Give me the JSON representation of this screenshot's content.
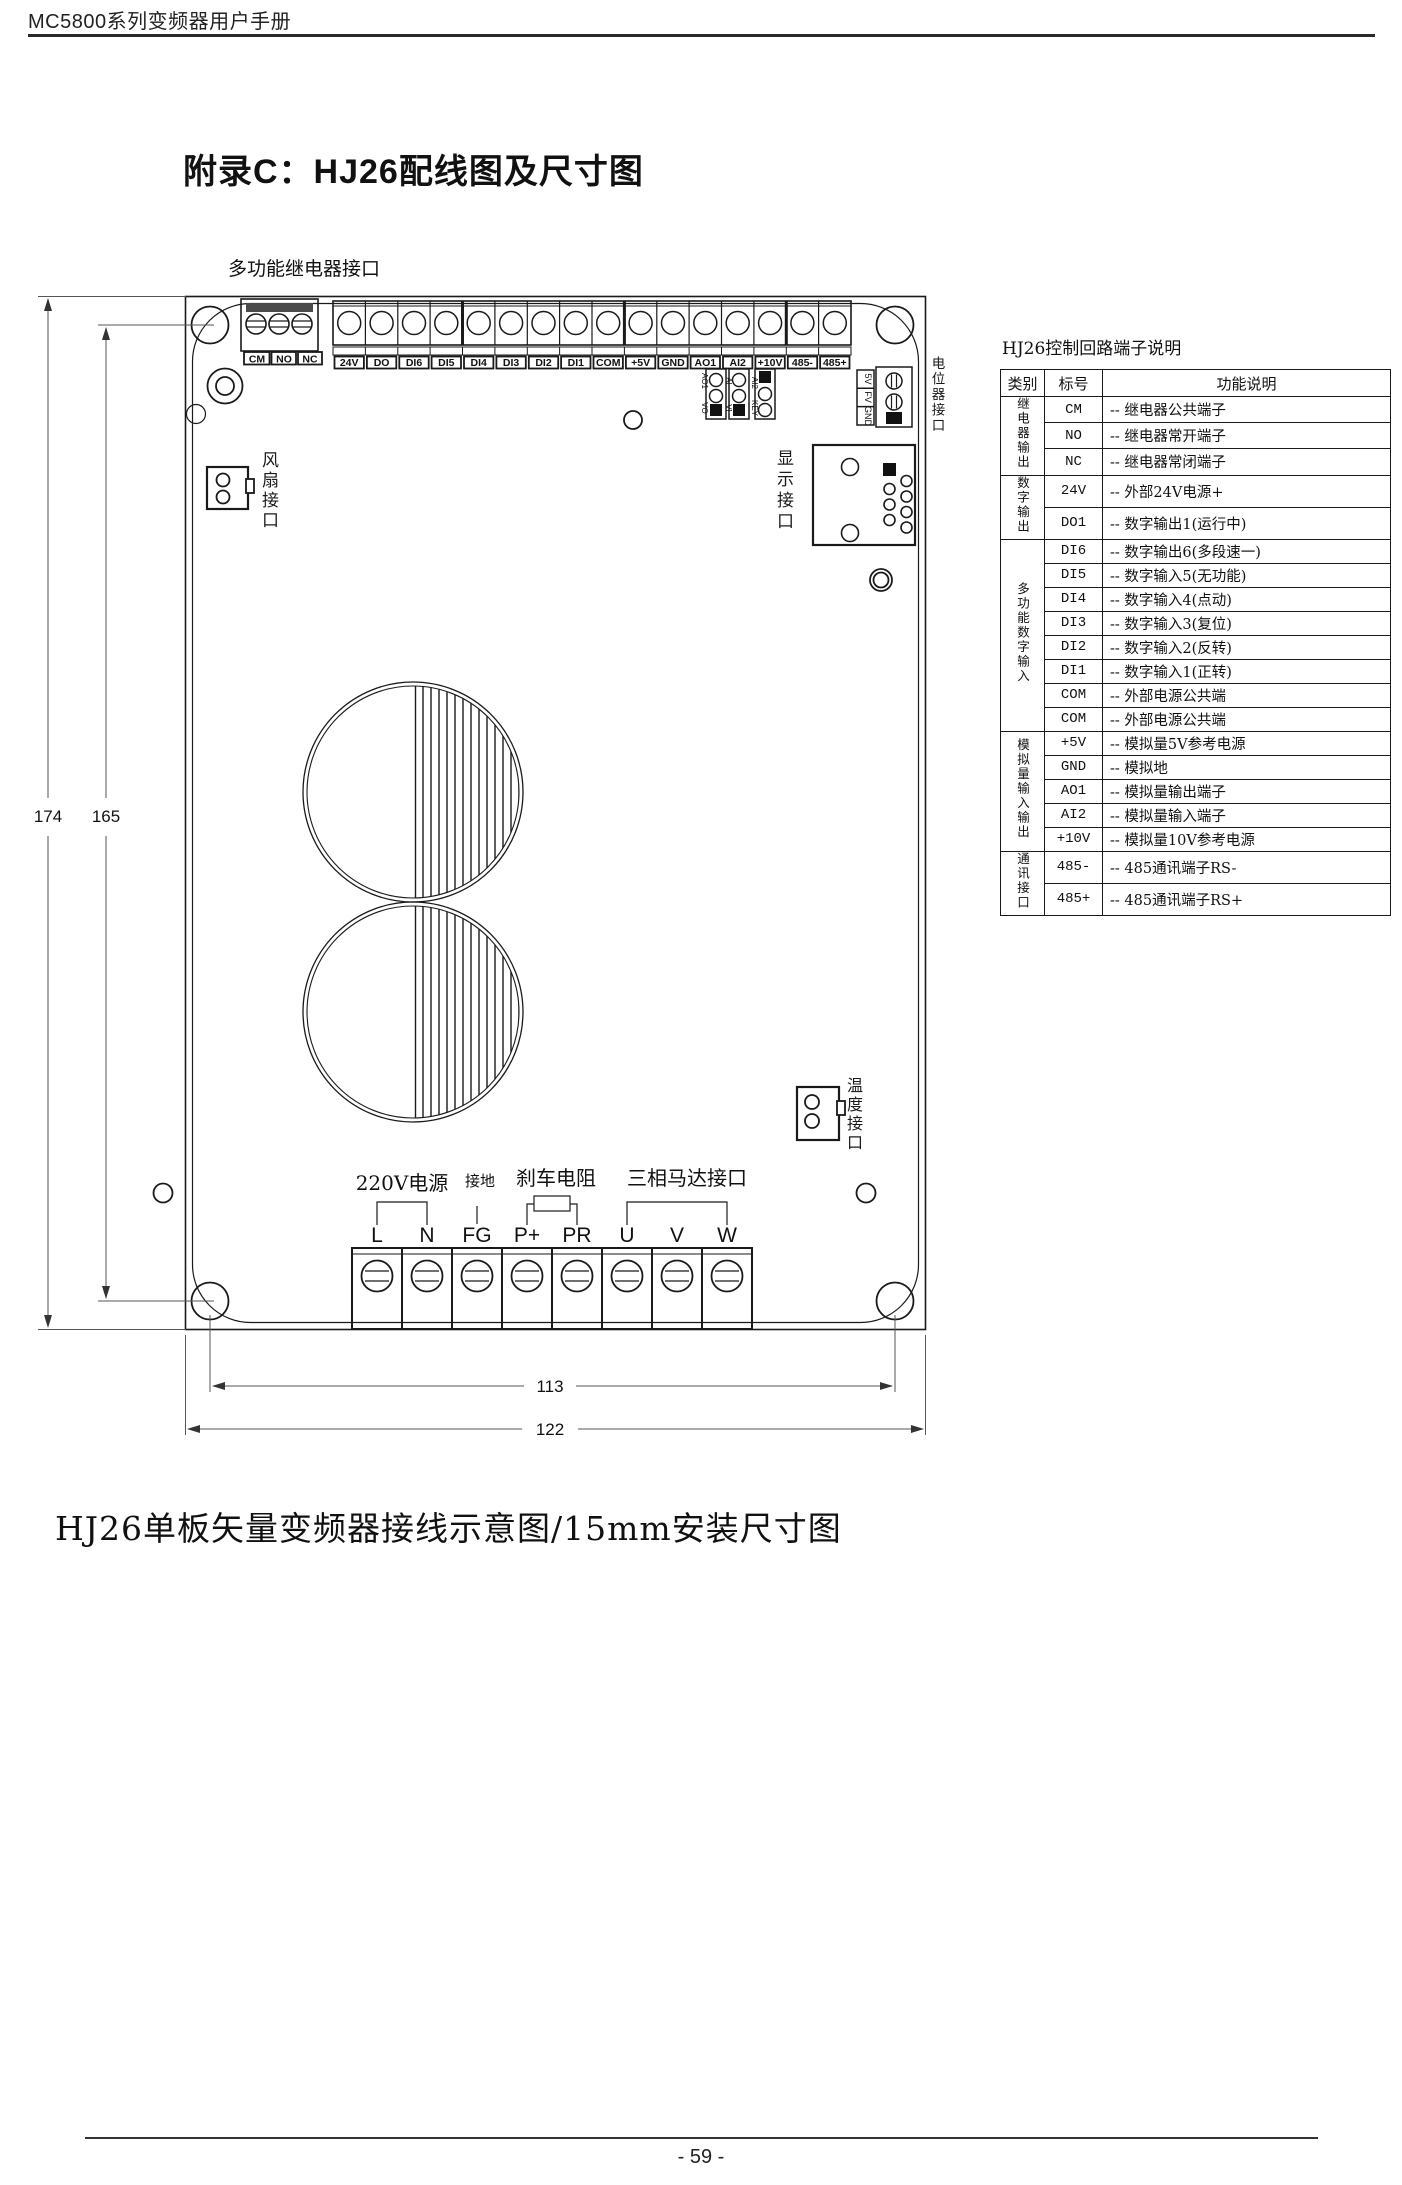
{
  "page": {
    "header": "MC5800系列变频器用户手册",
    "title": "附录C：HJ26配线图及尺寸图",
    "caption": "HJ26单板矢量变频器接线示意图/15mm安装尺寸图",
    "footer": "- 59 -"
  },
  "board": {
    "labels": {
      "relay_port": "多功能继电器接口",
      "fan_port": "风扇接口",
      "display_port": "显示接口",
      "pot_port": "电位器接口",
      "temp_port": "温度接口"
    },
    "relay_terminals": [
      "CM",
      "NO",
      "NC"
    ],
    "top_terminals": [
      "24V",
      "DO",
      "DI6",
      "DI5",
      "DI4",
      "DI3",
      "DI2",
      "DI1",
      "COM",
      "+5V",
      "GND",
      "AO1",
      "AI2",
      "+10V",
      "485-",
      "485+"
    ],
    "jumpers": [
      {
        "top": "AO1",
        "bottom": "VO"
      },
      {
        "top": "AI",
        "bottom": "VI"
      },
      {
        "top": "AI2",
        "bottom": "KEY"
      }
    ],
    "pot_pins": [
      "5V",
      "FV",
      "GND"
    ],
    "bottom_terminals": [
      "L",
      "N",
      "FG",
      "P+",
      "PR",
      "U",
      "V",
      "W"
    ],
    "bottom_groups": {
      "power": "220V电源",
      "ground": "接地",
      "brake": "刹车电阻",
      "motor": "三相马达接口"
    }
  },
  "dimensions": {
    "height_outer": "174",
    "height_inner": "165",
    "width_inner": "113",
    "width_outer": "122"
  },
  "table": {
    "title": "HJ26控制回路端子说明",
    "headers": [
      "类别",
      "标号",
      "功能说明"
    ],
    "groups": [
      {
        "category": "继电器输出",
        "rows": [
          [
            "CM",
            "-- 继电器公共端子"
          ],
          [
            "NO",
            "-- 继电器常开端子"
          ],
          [
            "NC",
            "-- 继电器常闭端子"
          ]
        ]
      },
      {
        "category": "数字输出",
        "rows": [
          [
            "24V",
            "-- 外部24V电源+"
          ],
          [
            "DO1",
            "-- 数字输出1(运行中)"
          ]
        ]
      },
      {
        "category": "多功能数字输入",
        "rows": [
          [
            "DI6",
            "-- 数字输出6(多段速一)"
          ],
          [
            "DI5",
            "-- 数字输入5(无功能)"
          ],
          [
            "DI4",
            "-- 数字输入4(点动)"
          ],
          [
            "DI3",
            "-- 数字输入3(复位)"
          ],
          [
            "DI2",
            "-- 数字输入2(反转)"
          ],
          [
            "DI1",
            "-- 数字输入1(正转)"
          ],
          [
            "COM",
            "-- 外部电源公共端"
          ],
          [
            "COM",
            "-- 外部电源公共端"
          ]
        ]
      },
      {
        "category": "模拟量输入输出",
        "rows": [
          [
            "+5V",
            "-- 模拟量5V参考电源"
          ],
          [
            "GND",
            "-- 模拟地"
          ],
          [
            "AO1",
            "-- 模拟量输出端子"
          ],
          [
            "AI2",
            "-- 模拟量输入端子"
          ],
          [
            "+10V",
            "-- 模拟量10V参考电源"
          ]
        ]
      },
      {
        "category": "通讯接口",
        "rows": [
          [
            "485-",
            "-- 485通讯端子RS-"
          ],
          [
            "485+",
            "-- 485通讯端子RS+"
          ]
        ]
      }
    ]
  }
}
